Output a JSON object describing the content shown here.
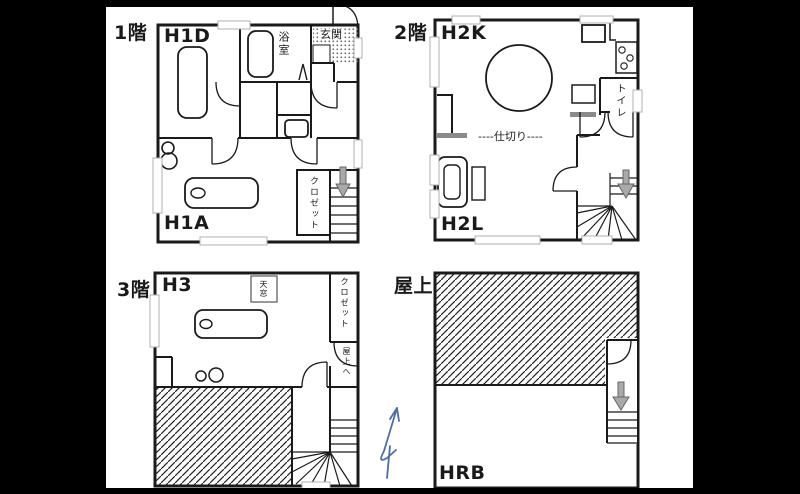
{
  "sheet": {
    "description": "4-floor house plan sheet",
    "colors": {
      "wall": "#1a1a1a",
      "stair_arrow_gray": "#a9a9a9",
      "fixture_gray": "#8a8a8a",
      "north_arrow_blue": "#4a6fa8",
      "letterbox": "#000000",
      "paper": "#ffffff"
    }
  },
  "plans": {
    "f1": {
      "floor_label": "1階",
      "unit_top": "H1D",
      "unit_bottom": "H1A",
      "bathroom": "浴室",
      "entrance": "玄関",
      "closet": "クロゼット"
    },
    "f2": {
      "floor_label": "2階",
      "unit_top": "H2K",
      "unit_bottom": "H2L",
      "toilet": "トイレ",
      "partition": "----仕切り----"
    },
    "f3": {
      "floor_label": "3階",
      "unit": "H3",
      "skylight": "天窓",
      "closet": "クロゼット",
      "to_roof": "屋上へ"
    },
    "roof": {
      "floor_label": "屋上",
      "unit": "HRB"
    }
  }
}
